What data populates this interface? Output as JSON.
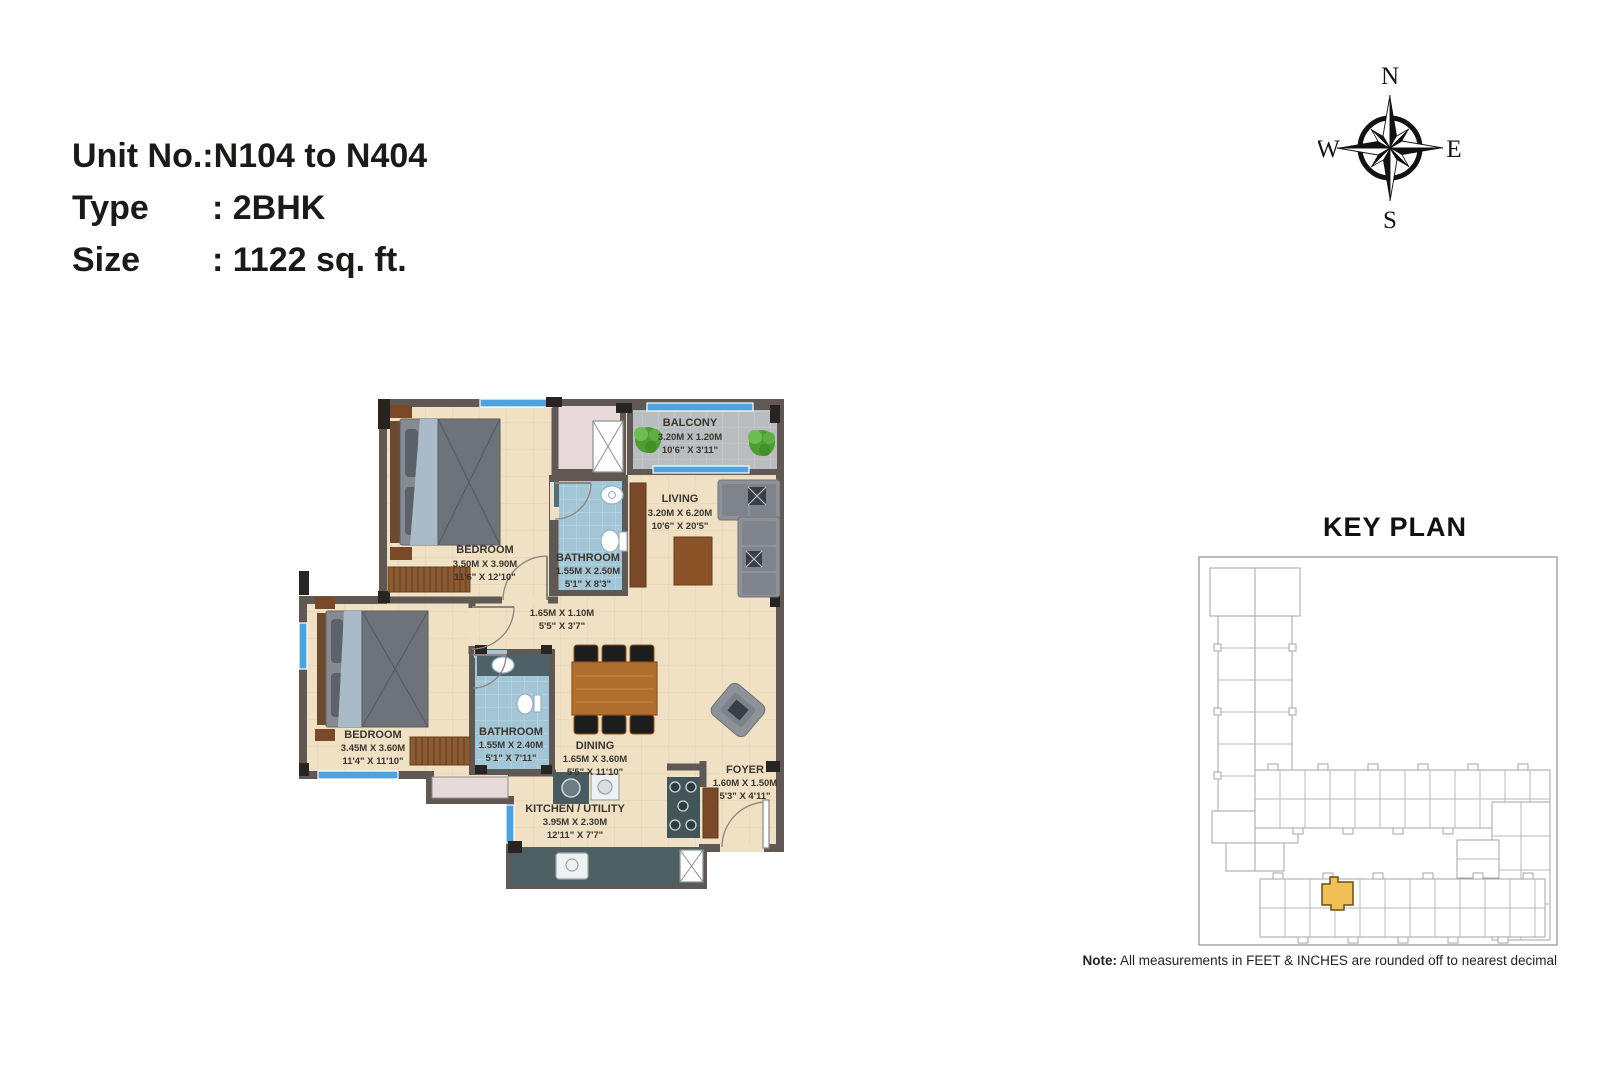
{
  "unit_info": {
    "rows": [
      {
        "label": "Unit No.:",
        "value": "N104 to N404"
      },
      {
        "label": "Type",
        "value": ": 2BHK"
      },
      {
        "label": "Size",
        "value": ": 1122 sq. ft."
      }
    ]
  },
  "compass": {
    "n": "N",
    "e": "E",
    "s": "S",
    "w": "W"
  },
  "floor_plan": {
    "rooms": [
      {
        "id": "bedroom1",
        "name": "BEDROOM",
        "dim_m": "3.50M X 3.90M",
        "dim_ft": "11'6\" X 12'10\""
      },
      {
        "id": "bathroom1",
        "name": "BATHROOM",
        "dim_m": "1.55M X 2.50M",
        "dim_ft": "5'1\" X 8'3\""
      },
      {
        "id": "balcony",
        "name": "BALCONY",
        "dim_m": "3.20M X 1.20M",
        "dim_ft": "10'6\" X 3'11\""
      },
      {
        "id": "living",
        "name": "LIVING",
        "dim_m": "3.20M X 6.20M",
        "dim_ft": "10'6\" X 20'5\""
      },
      {
        "id": "passage",
        "name": "",
        "dim_m": "1.65M X 1.10M",
        "dim_ft": "5'5\" X 3'7\""
      },
      {
        "id": "bedroom2",
        "name": "BEDROOM",
        "dim_m": "3.45M X 3.60M",
        "dim_ft": "11'4\" X 11'10\""
      },
      {
        "id": "bathroom2",
        "name": "BATHROOM",
        "dim_m": "1.55M X 2.40M",
        "dim_ft": "5'1\" X 7'11\""
      },
      {
        "id": "dining",
        "name": "DINING",
        "dim_m": "1.65M X 3.60M",
        "dim_ft": "5'5\" X 11'10\""
      },
      {
        "id": "kitchen",
        "name": "KITCHEN / UTILITY",
        "dim_m": "3.95M X 2.30M",
        "dim_ft": "12'11\" X 7'7\""
      },
      {
        "id": "foyer",
        "name": "FOYER",
        "dim_m": "1.60M X 1.50M",
        "dim_ft": "5'3\" X 4'11\""
      }
    ]
  },
  "key_plan": {
    "title": "KEY PLAN"
  },
  "note": {
    "label": "Note:",
    "text": " All measurements in FEET & INCHES are rounded off to nearest decimal"
  },
  "colors": {
    "highlight": "#f0c056",
    "window_blue": "#4da3e0",
    "wall": "#5f5855",
    "floor_tile": "#f0e1c5",
    "bathroom_tile": "#a3c6d6",
    "balcony_tile": "#b9bdbf",
    "wood": "#8a5a32",
    "label_text": "#3a352e"
  }
}
